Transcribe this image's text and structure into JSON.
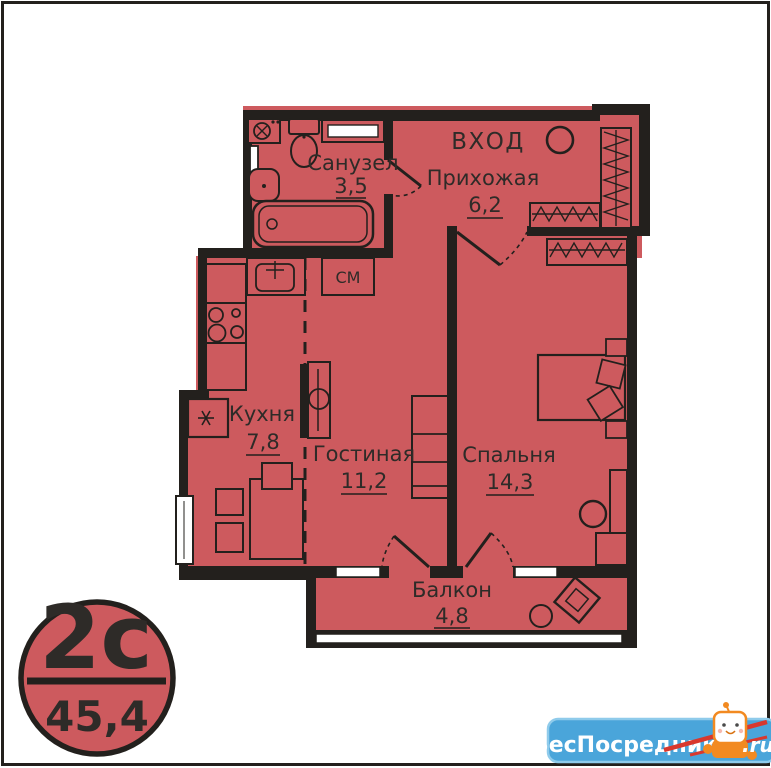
{
  "plan": {
    "entrance_label": "ВХОД",
    "rooms": [
      {
        "id": "bathroom",
        "name": "Санузел",
        "area": "3,5"
      },
      {
        "id": "hallway",
        "name": "Прихожая",
        "area": "6,2"
      },
      {
        "id": "kitchen",
        "name": "Кухня",
        "area": "7,8"
      },
      {
        "id": "living",
        "name": "Гостиная",
        "area": "11,2"
      },
      {
        "id": "bedroom",
        "name": "Спальня",
        "area": "14,3"
      },
      {
        "id": "balcony",
        "name": "Балкон",
        "area": "4,8"
      }
    ],
    "appliances": {
      "washing_machine": "СМ"
    }
  },
  "badge": {
    "unit_type": "2с",
    "total_area": "45,4"
  },
  "watermark": {
    "site": "БесПосредника",
    "tld": ".ru"
  },
  "colors": {
    "room_fill": "#cd5a5e",
    "wall": "#23201d",
    "text_color": "#2e2b28",
    "watermark_blue": "#4aa5da",
    "watermark_border": "#8fcbeb",
    "mascot_orange": "#f28a21",
    "pencil_red": "#d8382e"
  }
}
